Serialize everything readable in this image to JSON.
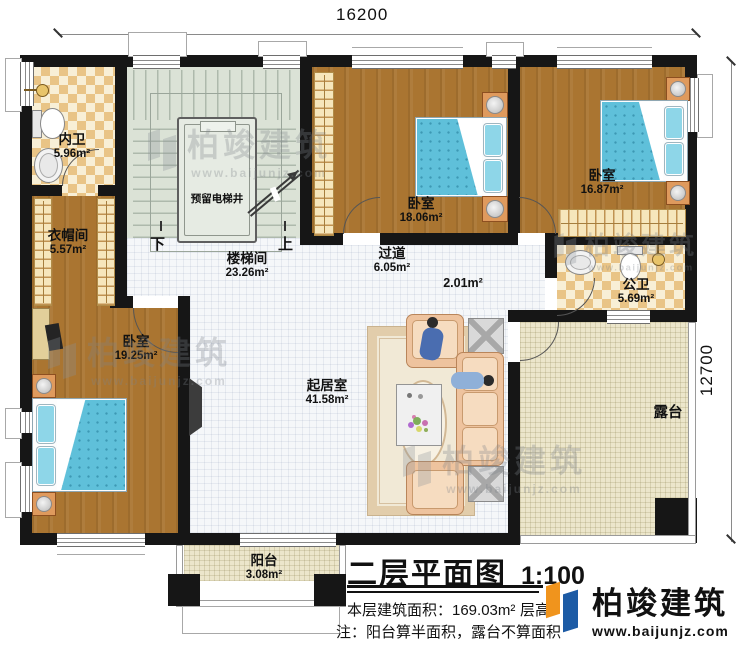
{
  "dimensions": {
    "width": "16200",
    "height": "12700"
  },
  "title": {
    "text": "二层平面图",
    "scale": "1:100"
  },
  "info": {
    "area": "本层建筑面积：169.03m²",
    "floor_height": "层高：3",
    "note": "注：阳台算半面积，露台不算面积"
  },
  "brand": {
    "name": "柏竣建筑",
    "url": "www.baijunjz.com"
  },
  "watermark": {
    "name": "柏竣建筑",
    "url": "www.baijunjz.com"
  },
  "colors": {
    "logo_orange": "#f0941d",
    "logo_blue": "#1d5ba5",
    "bed_blue": "#5fc0da",
    "wood": "#aa7531"
  },
  "stairwell": {
    "down": "下",
    "up": "上",
    "elevator": "预留电梯井"
  },
  "rooms": {
    "inner_bath": {
      "name": "内卫",
      "area": "5.96m²"
    },
    "cloakroom": {
      "name": "衣帽间",
      "area": "5.57m²"
    },
    "stair_hall": {
      "name": "楼梯间",
      "area": "23.26m²"
    },
    "bedroom_mid": {
      "name": "卧室",
      "area": "18.06m²"
    },
    "bedroom_right": {
      "name": "卧室",
      "area": "16.87m²"
    },
    "corridor": {
      "name": "过道",
      "area": "6.05m²"
    },
    "lobby": {
      "area": "2.01m²"
    },
    "public_bath": {
      "name": "公卫",
      "area": "5.69m²"
    },
    "bedroom_left": {
      "name": "卧室",
      "area": "19.25m²"
    },
    "living": {
      "name": "起居室",
      "area": "41.58m²"
    },
    "terrace": {
      "name": "露台"
    },
    "balcony": {
      "name": "阳台",
      "area": "3.08m²"
    }
  }
}
